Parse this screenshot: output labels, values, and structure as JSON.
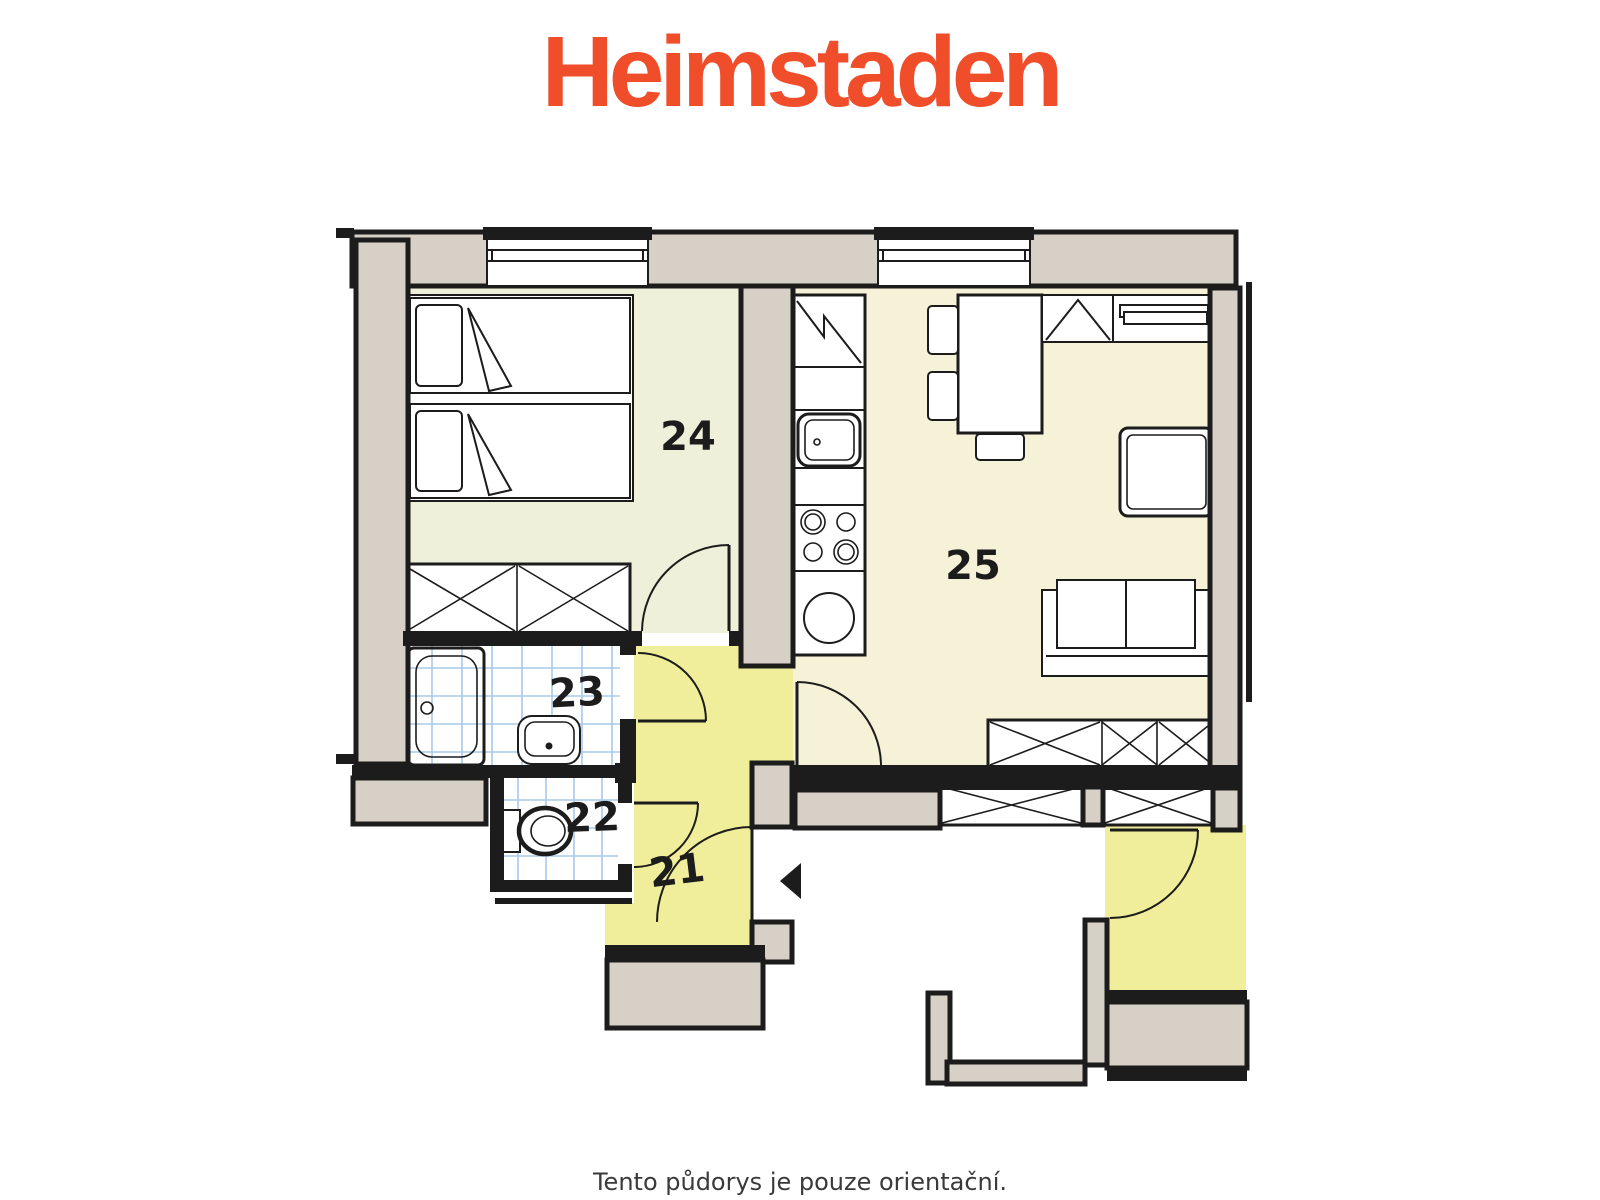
{
  "logo": {
    "text": "Heimstaden"
  },
  "caption": "Tento půdorys je pouze orientační.",
  "rooms": {
    "hallway": {
      "number": "21"
    },
    "wc": {
      "number": "22"
    },
    "bathroom": {
      "number": "23"
    },
    "bedroom": {
      "number": "24"
    },
    "living_room": {
      "number": "25"
    }
  },
  "icons": {
    "entry_arrow": "left-pointing-triangle"
  },
  "colors": {
    "brand": "#f04e2a",
    "ink": "#1c1c1c",
    "wall": "#d7d0c6",
    "floor-bedroom": "#eef0d9",
    "floor-living": "#f6f2d8",
    "floor-hall": "#f1ee9b",
    "tile": "#a9c8e9",
    "caption": "#3a3a3a"
  }
}
